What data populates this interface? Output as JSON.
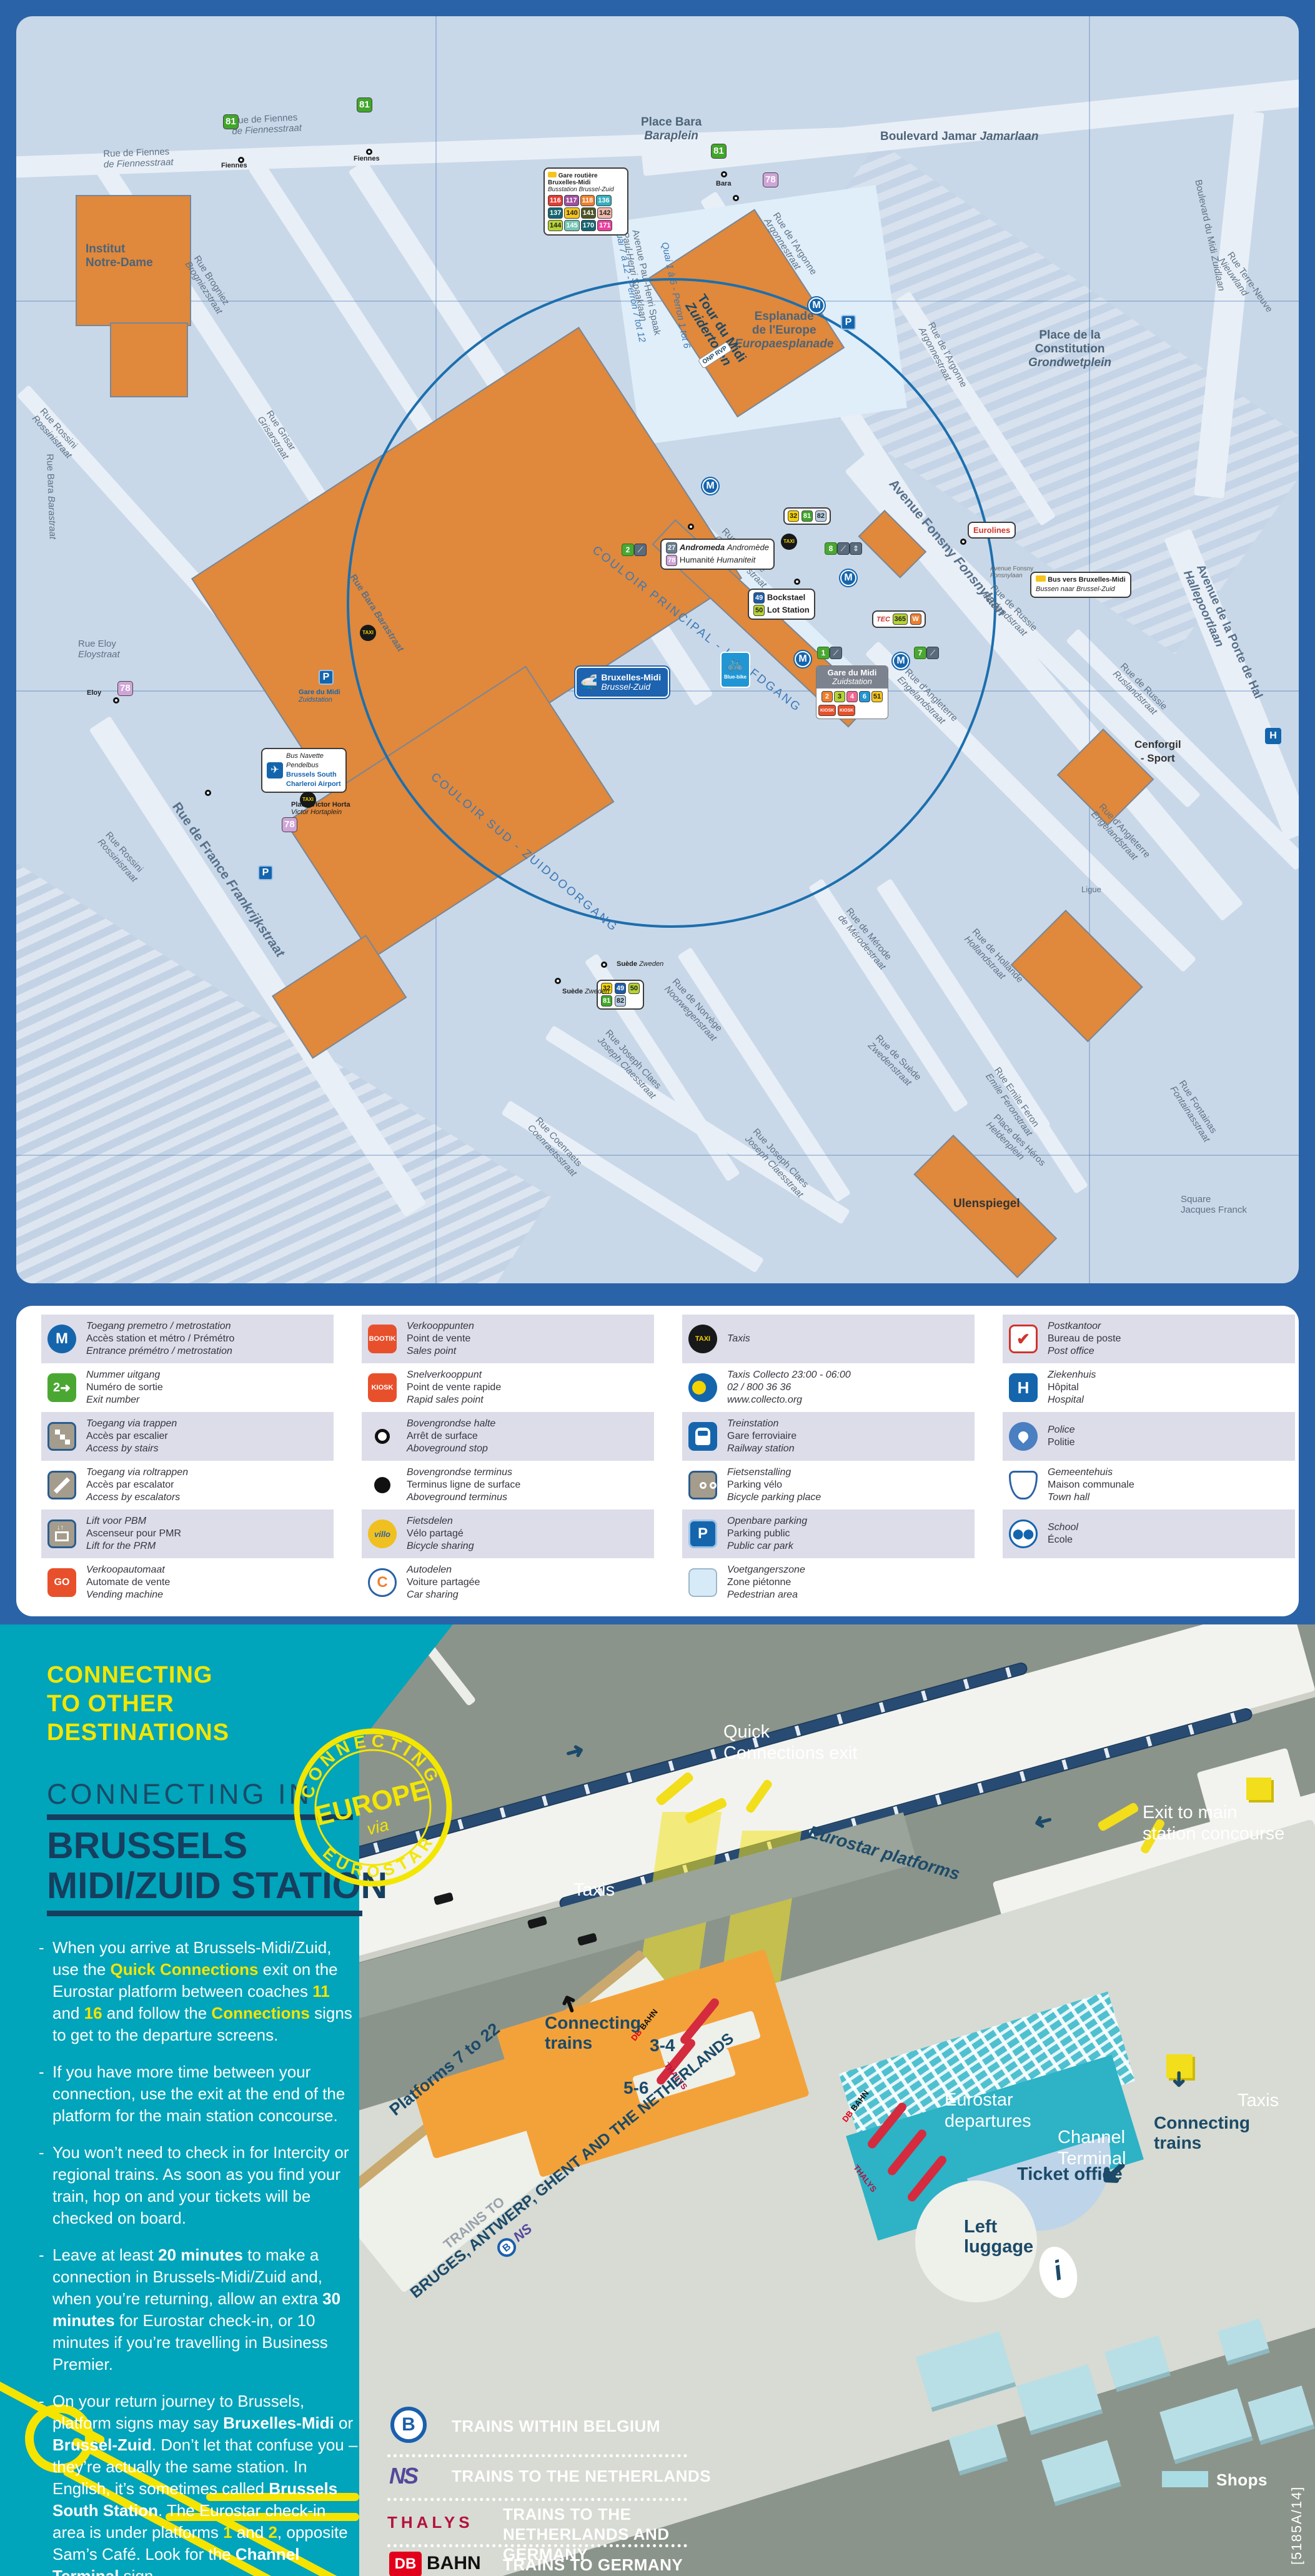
{
  "colors": {
    "frame": "#2b63a8",
    "map_bg": "#c9d8e8",
    "building_orange": "#e0883b",
    "teal": "#00a4bb",
    "yellow": "#f3e600",
    "navy": "#163e5e",
    "diagram_bg": "#8b948b",
    "terminal_teal": "#2db2c6",
    "shops_blue": "#aadce4",
    "thalys_red": "#d42b3e"
  },
  "map": {
    "sign": {
      "fr": "Bruxelles-Midi",
      "nl": "Brussel-Zuid"
    },
    "premetro": {
      "fr": "Gare du Midi",
      "nl": "Zuidstation",
      "lines": [
        "2",
        "3",
        "4",
        "6",
        "51"
      ],
      "kiosk": "KIOSK"
    },
    "busstation": {
      "fr": "Gare routière Bruxelles-Midi",
      "nl": "Busstation Brussel-Zuid",
      "routes": [
        "116",
        "117",
        "118",
        "136",
        "137",
        "140",
        "141",
        "142",
        "144",
        "145",
        "170",
        "171"
      ]
    },
    "airport": {
      "l1": "Bus Navette",
      "l2": "Pendelbus",
      "l3": "Brussels South",
      "l4": "Charleroi Airport"
    },
    "busvers": {
      "fr": "Bus vers Bruxelles-Midi",
      "nl": "Bussen naar Brussel-Zuid"
    },
    "tec": {
      "name": "TEC",
      "num": "365",
      "w": "W"
    },
    "icons": {
      "m": "M",
      "p": "P",
      "taxi": "TAXI",
      "villo": "villo",
      "bluebike": "Blue-bike",
      "h": "H",
      "onp_a": "ONP",
      "onp_b": "RVP"
    },
    "routes": {
      "r81": "81",
      "r78": "78",
      "r32": "32",
      "r82": "82",
      "r49": "49",
      "r50": "50",
      "r27": "27"
    },
    "stops": {
      "fiennes": "Fiennes",
      "bara": "Bara",
      "eloy": "Eloy",
      "suede": "Suède",
      "zweden": "Zweden",
      "andromeda": "Andromeda",
      "andromede": "Andromède",
      "humanite": "Humanité",
      "humaniteit": "Humaniteit",
      "bockstael": "Bockstael",
      "lot": "Lot Station",
      "eurolines": "Eurolines"
    },
    "streets": [
      {
        "a": "Rue de Fiennes",
        "b": "de Fiennesstraat"
      },
      {
        "a": "Place Bara",
        "b": "Baraplein"
      },
      {
        "a": "Boulevard Jamar",
        "b": "Jamarlaan"
      },
      {
        "a": "Institut",
        "b": "Notre-Dame"
      },
      {
        "a": "Rue Brogniez",
        "b": "Brogniezstraat"
      },
      {
        "a": "Rue Rossini",
        "b": "Rossinistraat"
      },
      {
        "a": "Rue Grisar",
        "b": "Grisarstraat"
      },
      {
        "a": "Rue Bara",
        "b": "Barastraat"
      },
      {
        "a": "Rue de l'Argonne",
        "b": "Argonnestraat"
      },
      {
        "a": "Esplanade",
        "b": "de l'Europe",
        "c": "Europaesplanade"
      },
      {
        "a": "Place de la",
        "b": "Constitution",
        "c": "Grondwetplein"
      },
      {
        "a": "Tour du Midi",
        "b": "Zuidertoren"
      },
      {
        "a": "Avenue Paul-Henri Spaak",
        "b": "Paul-Henri Spaaklaan"
      },
      {
        "a": "Quai 7 à 12 - Perron 7 tot 12"
      },
      {
        "a": "Quai 1 à 6 - Perron 1 tot 6"
      },
      {
        "a": "COULOIR PRINCIPAL - HOOFDGANG"
      },
      {
        "a": "COULOIR SUD - ZUIDDOORGANG"
      },
      {
        "a": "Rue Couverte",
        "b": "Overdekte straat"
      },
      {
        "a": "Avenue Fonsny",
        "b": "Fonsnylaan"
      },
      {
        "a": "Rue de France",
        "b": "Frankrijkstraat"
      },
      {
        "a": "Rue de Russie",
        "b": "Ruslandstraat"
      },
      {
        "a": "Rue d'Angleterre",
        "b": "Engelandstraat"
      },
      {
        "a": "Avenue de la Porte de Hal",
        "b": "Hallepoortlaan"
      },
      {
        "a": "Cenforgil",
        "b": "- Sport"
      },
      {
        "a": "Ulenspiegel"
      },
      {
        "a": "Rue de Suède",
        "b": "Zwedenstraat"
      },
      {
        "a": "Rue de Norvège",
        "b": "Noorwegenstraat"
      },
      {
        "a": "Rue Joseph Claes",
        "b": "Joseph Claesstraat"
      },
      {
        "a": "Rue Coenraets",
        "b": "Coenraetsstraat"
      },
      {
        "a": "Rue de Hollande",
        "b": "Hollandstraat"
      },
      {
        "a": "Rue Emile Feron",
        "b": "Emile Feronstraat"
      },
      {
        "a": "Place des Héros",
        "b": "Heldenplein"
      },
      {
        "a": "Rue de Mérode",
        "b": "de Mérodestraat"
      },
      {
        "a": "Place Victor Horta",
        "b": "Victor Hortaplein"
      },
      {
        "a": "Gare du Midi",
        "b": "Zuidstation"
      },
      {
        "a": "Rue Eloy",
        "b": "Eloystraat"
      },
      {
        "a": "Boulevard du Midi",
        "b": "Zuidlaan"
      },
      {
        "a": "Rue Terre-Neuve",
        "b": "Nieuwland"
      },
      {
        "a": "Square",
        "b": "Jacques Franck"
      },
      {
        "a": "Ligue"
      },
      {
        "a": "Rue Fontainas",
        "b": "Fontainasstraat"
      }
    ]
  },
  "legend": {
    "items": [
      {
        "nl": "Toegang premetro / metrostation",
        "fr": "Accès station et métro / Prémétro",
        "en": "Entrance prémétro / metrostation"
      },
      {
        "nl": "Nummer uitgang",
        "fr": "Numéro de sortie",
        "en": "Exit number"
      },
      {
        "nl": "Toegang via trappen",
        "fr": "Accès par escalier",
        "en": "Access by stairs"
      },
      {
        "nl": "Toegang via roltrappen",
        "fr": "Accès par escalator",
        "en": "Access by escalators"
      },
      {
        "nl": "Lift voor PBM",
        "fr": "Ascenseur pour PMR",
        "en": "Lift for the PRM"
      },
      {
        "nl": "Verkoopautomaat",
        "fr": "Automate de vente",
        "en": "Vending machine"
      },
      {
        "nl": "Verkooppunten",
        "fr": "Point de vente",
        "en": "Sales point"
      },
      {
        "nl": "Snelverkooppunt",
        "fr": "Point de vente rapide",
        "en": "Rapid sales point"
      },
      {
        "nl": "Bovengrondse halte",
        "fr": "Arrêt de surface",
        "en": "Aboveground stop"
      },
      {
        "nl": "Bovengrondse terminus",
        "fr": "Terminus ligne de surface",
        "en": "Aboveground terminus"
      },
      {
        "nl": "Fietsdelen",
        "fr": "Vélo partagé",
        "en": "Bicycle sharing"
      },
      {
        "nl": "Autodelen",
        "fr": "Voiture partagée",
        "en": "Car sharing"
      },
      {
        "nl": "Taxis"
      },
      {
        "nl": "Taxis Collecto 23:00 - 06:00",
        "fr": "02 / 800 36 36",
        "en": "www.collecto.org"
      },
      {
        "nl": "Treinstation",
        "fr": "Gare ferroviaire",
        "en": "Railway station"
      },
      {
        "nl": "Fietsenstalling",
        "fr": "Parking vélo",
        "en": "Bicycle parking place"
      },
      {
        "nl": "Openbare parking",
        "fr": "Parking public",
        "en": "Public car park"
      },
      {
        "nl": "Voetgangerszone",
        "fr": "Zone piétonne",
        "en": "Pedestrian area"
      },
      {
        "nl": "Postkantoor",
        "fr": "Bureau de poste",
        "en": "Post office"
      },
      {
        "nl": "Ziekenhuis",
        "fr": "Hôpital",
        "en": "Hospital"
      },
      {
        "nl": "Police",
        "fr": "Politie"
      },
      {
        "nl": "Gemeentehuis",
        "fr": "Maison communale",
        "en": "Town hall"
      },
      {
        "nl": "School",
        "fr": "École"
      }
    ],
    "icon_text": {
      "m": "M",
      "exit": "2",
      "go": "GO",
      "bootik": "BOOTIK",
      "kiosk": "KIOSK",
      "taxi": "TAXI",
      "p": "P",
      "h": "H",
      "villo": "villo",
      "c": "C"
    }
  },
  "connecting": {
    "kicker": [
      "CONNECTING",
      "TO OTHER",
      "DESTINATIONS"
    ],
    "heading": "CONNECTING IN",
    "title": [
      "BRUSSELS",
      "MIDI/ZUID STATION"
    ],
    "stamp": {
      "top": "CONNECTING",
      "mid": "EUROPE",
      "via": "via",
      "bottom": "EUROSTAR"
    },
    "bullets": [
      {
        "seg": [
          {
            "t": "When you arrive at Brussels-Midi/Zuid, use the "
          },
          {
            "t": "Quick Connections"
          },
          {
            "t": " exit on the Eurostar platform between coaches "
          },
          {
            "t": "11"
          },
          {
            "t": " and "
          },
          {
            "t": "16"
          },
          {
            "t": " and follow the "
          },
          {
            "t": "Connections"
          },
          {
            "t": " signs to get to the departure screens."
          }
        ]
      },
      {
        "seg": [
          {
            "t": "If you have more time between your connection, use the exit at the end of the platform for the main station concourse."
          }
        ]
      },
      {
        "seg": [
          {
            "t": "You won’t need to check in for Intercity or regional trains. As soon as you find your train, hop on and your tickets will be checked on board."
          }
        ]
      },
      {
        "seg": [
          {
            "t": "Leave at least "
          },
          {
            "t": "20 minutes"
          },
          {
            "t": " to make a connection in Brussels-Midi/Zuid and, when you’re returning, allow an extra "
          },
          {
            "t": "30 minutes"
          },
          {
            "t": " for Eurostar check-in, or 10 minutes if you’re travelling in Business Premier."
          }
        ]
      },
      {
        "seg": [
          {
            "t": "On your return journey to Brussels, platform signs may say "
          },
          {
            "t": "Bruxelles-Midi"
          },
          {
            "t": " or "
          },
          {
            "t": "Brussel-Zuid"
          },
          {
            "t": ". Don’t let that confuse you – they’re actually the same station. In English, it’s sometimes called "
          },
          {
            "t": "Brussels South Station"
          },
          {
            "t": ". The Eurostar check-in area is under platforms "
          },
          {
            "t": "1"
          },
          {
            "t": " and "
          },
          {
            "t": "2"
          },
          {
            "t": ", opposite Sam’s Café. Look for the "
          },
          {
            "t": "Channel Terminal"
          },
          {
            "t": " sign."
          }
        ]
      }
    ]
  },
  "diagram": {
    "quick": {
      "l1": "Quick",
      "l2": "Connections exit"
    },
    "exitmain": {
      "l1": "Exit to main",
      "l2": "station concourse"
    },
    "platforms": "Eurostar platforms",
    "taxis": "Taxis",
    "conn": {
      "l1": "Connecting",
      "l2": "trains"
    },
    "t34": "3-4",
    "t56": "5-6",
    "p722": "Platforms 7 to 22",
    "trainsto": "TRAINS TO",
    "bruges": "BRUGES, ANTWERP, GHENT AND THE NETHERLANDS",
    "dep": {
      "l1": "Eurostar",
      "l2": "departures"
    },
    "channel": {
      "l1": "Channel",
      "l2": "Terminal"
    },
    "ticket": "Ticket office",
    "luggage": {
      "l1": "Left",
      "l2": "luggage"
    },
    "info": "i",
    "legend": {
      "rows": [
        "TRAINS WITHIN BELGIUM",
        "TRAINS TO THE NETHERLANDS",
        "TRAINS TO THE NETHERLANDS AND GERMANY",
        "TRAINS TO GERMANY"
      ],
      "b": "B",
      "ns": "NS",
      "thalys": "THALYS",
      "db": "DB",
      "bahn": "BAHN"
    },
    "shops": "Shops",
    "ref": "[5185A/14]"
  }
}
